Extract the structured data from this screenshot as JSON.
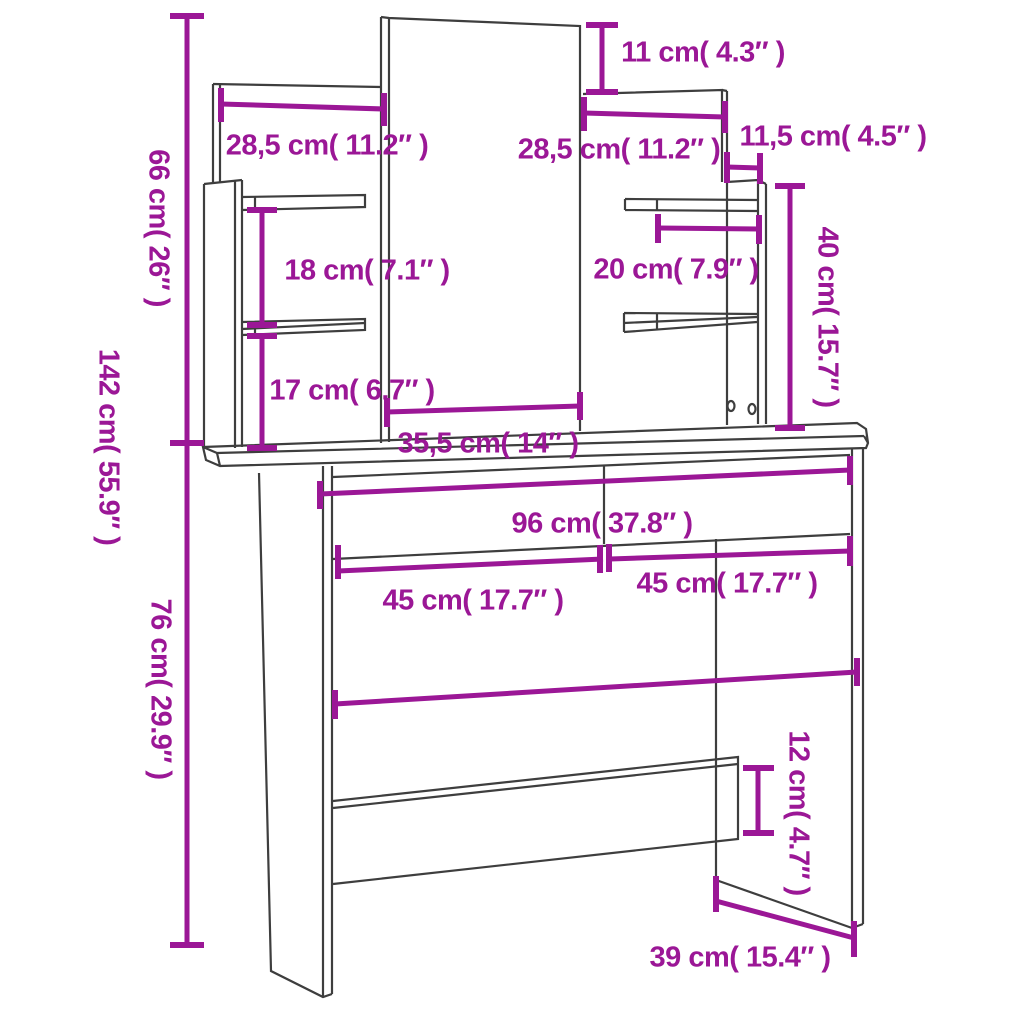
{
  "diagram": {
    "type": "furniture-dimension-diagram",
    "subject": "dressing table with mirror, side shelf posts, two drawers and base crossbar",
    "colors": {
      "accent": "#9B1796",
      "line": "#3E3E3E",
      "background": "#FFFFFF"
    },
    "dimensions": [
      {
        "part": "mirror-top-above-side-panel",
        "orientation": "vertical-line-horizontal-label",
        "label": "11 cm( 4.3″ )"
      },
      {
        "part": "left-back-panel-width",
        "orientation": "horizontal",
        "label": "28,5 cm( 11.2″ )"
      },
      {
        "part": "right-back-panel-width",
        "orientation": "horizontal",
        "label": "28,5 cm( 11.2″ )"
      },
      {
        "part": "side-post-depth",
        "orientation": "horizontal",
        "label": "11,5 cm( 4.5″ )"
      },
      {
        "part": "upper-unit-height",
        "orientation": "vertical",
        "label": "66 cm( 26″ )"
      },
      {
        "part": "left-shelf-spacing",
        "orientation": "vertical-line-horizontal-label",
        "label": "18 cm( 7.1″ )"
      },
      {
        "part": "right-shelf-length",
        "orientation": "horizontal",
        "label": "20 cm( 7.9″ )"
      },
      {
        "part": "right-post-height",
        "orientation": "vertical",
        "label": "40 cm( 15.7″ )"
      },
      {
        "part": "left-lower-shelf-spacing",
        "orientation": "vertical-line-horizontal-label",
        "label": "17 cm( 6.7″ )"
      },
      {
        "part": "total-height",
        "orientation": "vertical",
        "label": "142 cm( 55.9″ )"
      },
      {
        "part": "mirror-width",
        "orientation": "horizontal",
        "label": "35,5 cm( 14″ )"
      },
      {
        "part": "table-width",
        "orientation": "horizontal",
        "label": "96 cm( 37.8″ )"
      },
      {
        "part": "left-drawer-width",
        "orientation": "horizontal",
        "label": "45 cm( 17.7″ )"
      },
      {
        "part": "right-drawer-width",
        "orientation": "horizontal",
        "label": "45 cm( 17.7″ )"
      },
      {
        "part": "table-height",
        "orientation": "vertical",
        "label": "76 cm( 29.9″ )"
      },
      {
        "part": "crossbar-height",
        "orientation": "vertical",
        "label": "12 cm( 4.7″ )"
      },
      {
        "part": "table-depth",
        "orientation": "horizontal",
        "label": "39 cm( 15.4″ )"
      }
    ]
  }
}
